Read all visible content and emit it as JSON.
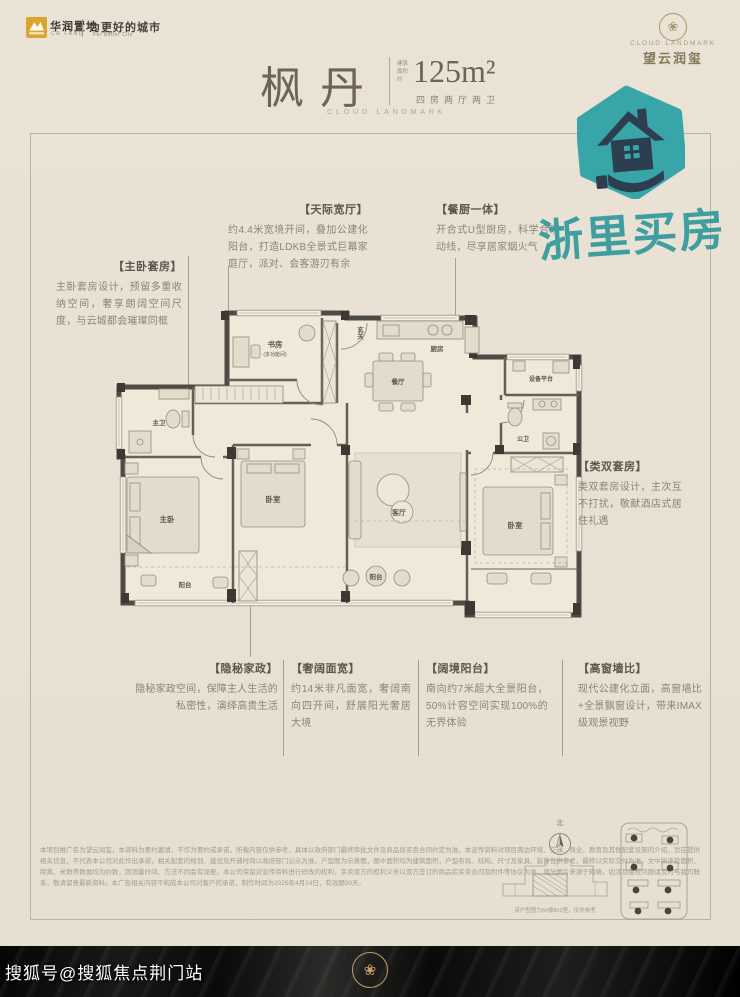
{
  "header": {
    "brand": {
      "name": "华润置地",
      "sub": "CR LAND",
      "slogan": "为更好的城市",
      "slogan_sub": "For Better City"
    },
    "unit": {
      "name": "枫丹",
      "area_note": "建筑面积约",
      "area": "125m²",
      "layout": "四房两厅两卫",
      "en": "CLOUD LANDMARK"
    },
    "project": {
      "en": "CLOUD LANDMARK",
      "cn": "望云润玺"
    }
  },
  "stamp": {
    "text": "浙里买房"
  },
  "colors": {
    "teal": "#3aa7a9",
    "icon_dark": "#2c3e50",
    "gold": "#bf9f63"
  },
  "callouts": {
    "sky_hall": {
      "title": "【天际宽厅】",
      "body": "约4.4米宽境开间，叠加公建化阳台，打造LDKB全景式巨幕家庭厅，派对、会客游刃有余"
    },
    "kitchen_dining": {
      "title": "【餐厨一体】",
      "body": "开合式U型厨房，科学合理动线，尽享居家烟火气"
    },
    "master_suite": {
      "title": "【主卧套房】",
      "body": "主卧套房设计，预留多重收纳空间，奢享朗阔空间尺度，与云城都会璀璨同框"
    },
    "twin_suite": {
      "title": "【类双套房】",
      "body": "类双套房设计，主次互不打扰，敬献酒店式居住礼遇"
    },
    "housework": {
      "title": "【隐秘家政】",
      "body": "隐秘家政空间，保障主人生活的私密性，演绎高贵生活"
    },
    "wide_facade": {
      "title": "【奢阔面宽】",
      "body": "约14米非凡面宽，奢阔南向四开间，舒展阳光奢居大境"
    },
    "balcony": {
      "title": "【阔境阳台】",
      "body": "南向约7米超大全景阳台，50%计容空间实现100%的无界体验"
    },
    "window_wall": {
      "title": "【高窗墙比】",
      "body": "现代公建化立面，高窗墙比+全景飘窗设计，带来IMAX级观景视野"
    }
  },
  "floorplan": {
    "rooms": {
      "entry": "玄关",
      "study": "书房",
      "study_sub": "(多功能间)",
      "kitchen": "厨房",
      "dining": "餐厅",
      "equipment": "设备平台",
      "guest_bath": "公卫",
      "master_bath": "主卫",
      "master_bed": "主卧",
      "bed2": "卧室",
      "living": "客厅",
      "bed3": "卧室",
      "balcony": "阳台",
      "balcony2": "阳台"
    }
  },
  "footer": {
    "disclaimer": "本项目推广名为望云润玺，本资料为要约邀请，不作为要约或承诺，所载内容仅供参考，具体以政府部门最终审批文件及商品房买卖合同约定为准。本宣传资料对项目周边环境、交通、商业、教育及其他配套设施的介绍，旨在提供相关信息，不代表本公司对此作出承诺，相关配套的规划、建设及开通时间以政府部门公示为准。户型图为示意图，图中面积均为建筑面积，户型布局、结构、尺寸及家具、装饰仅供参考，最终以实际交付为准。文中所涉及面积、距离、米数等数据均为约数，因测量时间、方法不同会有误差。本公司保留对宣传资料进行修改的权利，买卖双方的权利义务以双方签订的商品房买卖合同及附件等协议为准。部分图片来源于网络，如涉及版权问题请及时与我司联系，敬请留意最新资料。本广告相关内容不构成本公司对客户的承诺，制作时间为2025年4月14日，有效期30天。",
    "compass": "北",
    "keyplan_caption": "该户型图为6#楼802室，仅作参考",
    "watermark": "搜狐号@搜狐焦点荆门站"
  }
}
